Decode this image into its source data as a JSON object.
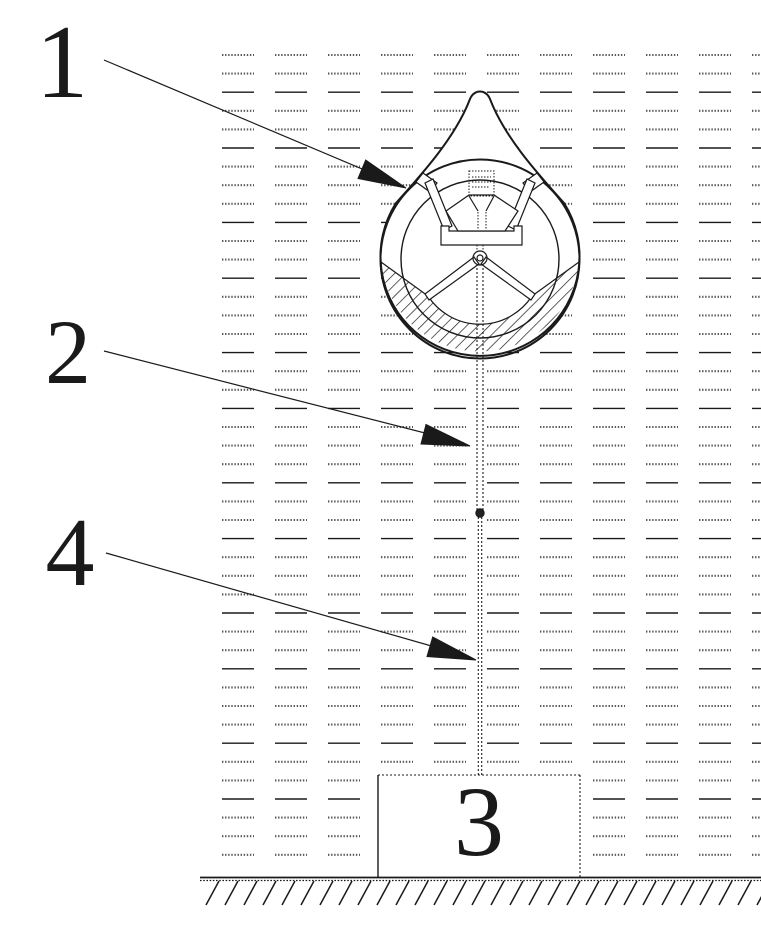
{
  "figure": {
    "labels": {
      "l1": "1",
      "l2": "2",
      "l3": "3",
      "l4": "4"
    }
  },
  "colors": {
    "ink": "#1a1a1a",
    "background": "#ffffff",
    "water_dot": "#3a3a3a"
  }
}
